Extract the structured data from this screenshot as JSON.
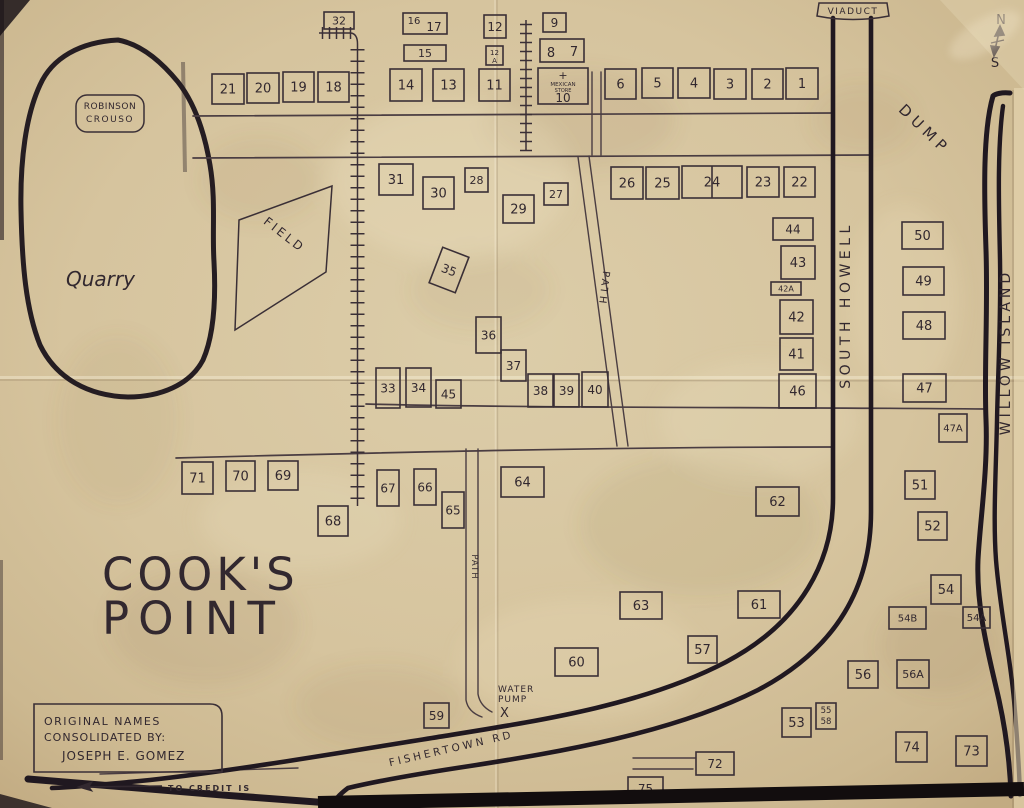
{
  "map": {
    "texts": [
      {
        "id": "viaduct-label",
        "t": "VIADUCT",
        "x": 853,
        "y": 14,
        "fs": 9,
        "ls": 1.5,
        "a": "middle"
      },
      {
        "id": "compass-n",
        "t": "N",
        "x": 1001,
        "y": 24,
        "fs": 13,
        "a": "middle"
      },
      {
        "id": "compass-s",
        "t": "S",
        "x": 995,
        "y": 67,
        "fs": 13,
        "a": "middle"
      },
      {
        "id": "dump-label",
        "t": "DUMP",
        "x": 921,
        "y": 133,
        "fs": 15,
        "ls": 5,
        "rot": 44,
        "a": "middle"
      },
      {
        "id": "south-howell-label",
        "t": "SOUTH HOWELL",
        "x": 850,
        "y": 305,
        "fs": 14,
        "ls": 4.5,
        "rot": -90,
        "a": "middle"
      },
      {
        "id": "willow-island-label",
        "t": "WILLOW ISLAND",
        "x": 1010,
        "y": 352,
        "fs": 14,
        "ls": 4,
        "rot": -90,
        "a": "middle"
      },
      {
        "id": "path-upper-label",
        "t": "PATH",
        "x": 601,
        "y": 288,
        "fs": 10,
        "ls": 2.5,
        "rot": 97,
        "a": "middle"
      },
      {
        "id": "path-lower-label",
        "t": "PATH",
        "x": 472,
        "y": 567,
        "fs": 8.5,
        "ls": 1,
        "rot": 90,
        "a": "middle"
      },
      {
        "id": "robinson-line1",
        "t": "ROBINSON",
        "x": 110,
        "y": 109,
        "fs": 9,
        "ls": 0.5,
        "a": "middle"
      },
      {
        "id": "robinson-line2",
        "t": "CROUSO",
        "x": 110,
        "y": 122,
        "fs": 9,
        "ls": 1.5,
        "a": "middle"
      },
      {
        "id": "quarry-label",
        "t": "Quarry",
        "x": 66,
        "y": 286,
        "fs": 20,
        "it": 1,
        "a": "start"
      },
      {
        "id": "field-label",
        "t": "FIELD",
        "x": 282,
        "y": 238,
        "fs": 12,
        "ls": 3,
        "rot": 38,
        "a": "middle"
      },
      {
        "id": "cooks-line1",
        "t": "COOK'S",
        "x": 102,
        "y": 590,
        "fs": 45,
        "ls": 4,
        "a": "start"
      },
      {
        "id": "cooks-line2",
        "t": "POINT",
        "x": 102,
        "y": 634,
        "fs": 45,
        "ls": 9,
        "a": "start"
      },
      {
        "id": "water-pump-line1",
        "t": "WATER",
        "x": 498,
        "y": 692,
        "fs": 9,
        "ls": 1,
        "a": "start"
      },
      {
        "id": "water-pump-line2",
        "t": "PUMP",
        "x": 498,
        "y": 702,
        "fs": 9,
        "ls": 1,
        "a": "start"
      },
      {
        "id": "water-pump-x",
        "t": "X",
        "x": 500,
        "y": 717,
        "fs": 13,
        "a": "start"
      },
      {
        "id": "fishertown-rd-label",
        "t": "FISHERTOWN RD",
        "x": 452,
        "y": 752,
        "fs": 10.5,
        "ls": 3,
        "rot": -13,
        "a": "middle"
      },
      {
        "id": "credits-line1",
        "t": "ORIGINAL NAMES",
        "x": 44,
        "y": 725,
        "fs": 11,
        "ls": 1.5,
        "a": "start"
      },
      {
        "id": "credits-line2",
        "t": "CONSOLIDATED BY:",
        "x": 44,
        "y": 741,
        "fs": 11,
        "ls": 1,
        "a": "start"
      },
      {
        "id": "credits-line3",
        "t": "JOSEPH E. GOMEZ",
        "x": 62,
        "y": 760,
        "fs": 12,
        "ls": 1,
        "a": "start"
      },
      {
        "id": "to-credit-label",
        "t": "TO CREDIT IS",
        "x": 168,
        "y": 791,
        "fs": 8,
        "ls": 2,
        "w": "bold",
        "a": "start"
      }
    ],
    "lots": [
      {
        "n": "32",
        "x": 324,
        "y": 12,
        "w": 30,
        "h": 17,
        "fs": 11
      },
      {
        "id": "16-17",
        "x": 403,
        "y": 13,
        "w": 44,
        "h": 21,
        "labels": [
          {
            "t": "16",
            "dx": 11,
            "dy": 11,
            "fs": 10
          },
          {
            "t": "17",
            "dx": 31,
            "dy": 18,
            "fs": 12
          }
        ]
      },
      {
        "n": "12",
        "x": 484,
        "y": 15,
        "w": 22,
        "h": 23,
        "fs": 12
      },
      {
        "n": "9",
        "x": 543,
        "y": 13,
        "w": 23,
        "h": 19,
        "fs": 12
      },
      {
        "n": "15",
        "x": 404,
        "y": 45,
        "w": 42,
        "h": 16,
        "fs": 11
      },
      {
        "id": "12A",
        "x": 486,
        "y": 46,
        "w": 17,
        "h": 19,
        "labels": [
          {
            "t": "12",
            "dx": 8.5,
            "dy": 9,
            "fs": 7
          },
          {
            "t": "A",
            "dx": 8.5,
            "dy": 17,
            "fs": 7
          }
        ]
      },
      {
        "id": "8-7",
        "x": 540,
        "y": 39,
        "w": 44,
        "h": 23,
        "labels": [
          {
            "t": "8",
            "dx": 11,
            "dy": 18,
            "fs": 13
          },
          {
            "t": "7",
            "dx": 34,
            "dy": 17,
            "fs": 13
          }
        ]
      },
      {
        "n": "21",
        "x": 212,
        "y": 74,
        "w": 32,
        "h": 30
      },
      {
        "n": "20",
        "x": 247,
        "y": 73,
        "w": 32,
        "h": 30
      },
      {
        "n": "19",
        "x": 283,
        "y": 72,
        "w": 31,
        "h": 30
      },
      {
        "n": "18",
        "x": 318,
        "y": 72,
        "w": 31,
        "h": 30
      },
      {
        "n": "14",
        "x": 390,
        "y": 69,
        "w": 32,
        "h": 32
      },
      {
        "n": "13",
        "x": 433,
        "y": 69,
        "w": 31,
        "h": 32
      },
      {
        "n": "11",
        "x": 479,
        "y": 69,
        "w": 31,
        "h": 32
      },
      {
        "id": "mexican-store-10",
        "x": 538,
        "y": 68,
        "w": 50,
        "h": 36,
        "labels": [
          {
            "t": "+",
            "dx": 25,
            "dy": 11,
            "fs": 11
          },
          {
            "t": "MEXICAN",
            "dx": 25,
            "dy": 18,
            "fs": 5.5
          },
          {
            "t": "STORE",
            "dx": 25,
            "dy": 24,
            "fs": 5
          },
          {
            "t": "10",
            "dx": 25,
            "dy": 34,
            "fs": 12
          }
        ]
      },
      {
        "n": "6",
        "x": 605,
        "y": 69,
        "w": 31,
        "h": 30
      },
      {
        "n": "5",
        "x": 642,
        "y": 68,
        "w": 31,
        "h": 30
      },
      {
        "n": "4",
        "x": 678,
        "y": 68,
        "w": 32,
        "h": 30
      },
      {
        "n": "3",
        "x": 714,
        "y": 69,
        "w": 32,
        "h": 30
      },
      {
        "n": "2",
        "x": 752,
        "y": 69,
        "w": 31,
        "h": 30
      },
      {
        "n": "1",
        "x": 786,
        "y": 68,
        "w": 32,
        "h": 31
      },
      {
        "n": "31",
        "x": 379,
        "y": 164,
        "w": 34,
        "h": 31
      },
      {
        "n": "30",
        "x": 423,
        "y": 177,
        "w": 31,
        "h": 32
      },
      {
        "n": "28",
        "x": 465,
        "y": 168,
        "w": 23,
        "h": 24,
        "fs": 11
      },
      {
        "n": "29",
        "x": 503,
        "y": 195,
        "w": 31,
        "h": 28
      },
      {
        "n": "27",
        "x": 544,
        "y": 183,
        "w": 24,
        "h": 22,
        "fs": 11
      },
      {
        "n": "26",
        "x": 611,
        "y": 167,
        "w": 32,
        "h": 32
      },
      {
        "n": "25",
        "x": 646,
        "y": 167,
        "w": 33,
        "h": 32
      },
      {
        "n": "24",
        "x": 682,
        "y": 166,
        "w": 60,
        "h": 32,
        "divider": true
      },
      {
        "n": "23",
        "x": 747,
        "y": 167,
        "w": 32,
        "h": 30
      },
      {
        "n": "22",
        "x": 784,
        "y": 167,
        "w": 31,
        "h": 30
      },
      {
        "n": "44",
        "x": 773,
        "y": 218,
        "w": 40,
        "h": 22,
        "fs": 12
      },
      {
        "n": "43",
        "x": 781,
        "y": 246,
        "w": 34,
        "h": 33
      },
      {
        "n": "42A",
        "x": 771,
        "y": 282,
        "w": 30,
        "h": 13,
        "fs": 8
      },
      {
        "n": "42",
        "x": 780,
        "y": 300,
        "w": 33,
        "h": 34
      },
      {
        "n": "41",
        "x": 780,
        "y": 338,
        "w": 33,
        "h": 32
      },
      {
        "n": "46",
        "x": 779,
        "y": 374,
        "w": 37,
        "h": 34
      },
      {
        "n": "50",
        "x": 902,
        "y": 222,
        "w": 41,
        "h": 27
      },
      {
        "n": "49",
        "x": 903,
        "y": 267,
        "w": 41,
        "h": 28
      },
      {
        "n": "48",
        "x": 903,
        "y": 312,
        "w": 42,
        "h": 27
      },
      {
        "n": "47",
        "x": 903,
        "y": 374,
        "w": 43,
        "h": 28
      },
      {
        "n": "47A",
        "x": 939,
        "y": 414,
        "w": 28,
        "h": 28,
        "fs": 10
      },
      {
        "n": "35",
        "x": 435,
        "y": 251,
        "w": 28,
        "h": 38,
        "rot": 21,
        "fs": 12
      },
      {
        "n": "36",
        "x": 476,
        "y": 317,
        "w": 25,
        "h": 36,
        "fs": 12
      },
      {
        "n": "37",
        "x": 501,
        "y": 350,
        "w": 25,
        "h": 31,
        "fs": 12
      },
      {
        "n": "33",
        "x": 376,
        "y": 368,
        "w": 24,
        "h": 40,
        "fs": 12
      },
      {
        "n": "34",
        "x": 406,
        "y": 368,
        "w": 25,
        "h": 39,
        "fs": 12
      },
      {
        "n": "45",
        "x": 436,
        "y": 380,
        "w": 25,
        "h": 28,
        "fs": 12
      },
      {
        "n": "38",
        "x": 528,
        "y": 374,
        "w": 25,
        "h": 33,
        "fs": 12
      },
      {
        "n": "39",
        "x": 554,
        "y": 374,
        "w": 25,
        "h": 33,
        "fs": 12
      },
      {
        "n": "40",
        "x": 582,
        "y": 372,
        "w": 26,
        "h": 35,
        "fs": 12
      },
      {
        "n": "71",
        "x": 182,
        "y": 462,
        "w": 31,
        "h": 32
      },
      {
        "n": "70",
        "x": 226,
        "y": 461,
        "w": 29,
        "h": 30
      },
      {
        "n": "69",
        "x": 268,
        "y": 461,
        "w": 30,
        "h": 29
      },
      {
        "n": "68",
        "x": 318,
        "y": 506,
        "w": 30,
        "h": 30
      },
      {
        "n": "67",
        "x": 377,
        "y": 470,
        "w": 22,
        "h": 36,
        "fs": 12
      },
      {
        "n": "66",
        "x": 414,
        "y": 469,
        "w": 22,
        "h": 36,
        "fs": 12
      },
      {
        "n": "65",
        "x": 442,
        "y": 492,
        "w": 22,
        "h": 36,
        "fs": 12
      },
      {
        "n": "64",
        "x": 501,
        "y": 467,
        "w": 43,
        "h": 30
      },
      {
        "n": "62",
        "x": 756,
        "y": 487,
        "w": 43,
        "h": 29
      },
      {
        "n": "51",
        "x": 905,
        "y": 471,
        "w": 30,
        "h": 28
      },
      {
        "n": "52",
        "x": 918,
        "y": 512,
        "w": 29,
        "h": 28
      },
      {
        "n": "54",
        "x": 931,
        "y": 575,
        "w": 30,
        "h": 29
      },
      {
        "n": "54B",
        "x": 889,
        "y": 607,
        "w": 37,
        "h": 22,
        "fs": 10
      },
      {
        "n": "54A",
        "x": 963,
        "y": 607,
        "w": 27,
        "h": 21,
        "fs": 10
      },
      {
        "n": "56",
        "x": 848,
        "y": 661,
        "w": 30,
        "h": 27
      },
      {
        "n": "56A",
        "x": 897,
        "y": 660,
        "w": 32,
        "h": 28,
        "fs": 11
      },
      {
        "id": "55-58",
        "x": 816,
        "y": 703,
        "w": 20,
        "h": 26,
        "labels": [
          {
            "t": "55",
            "dx": 10,
            "dy": 10,
            "fs": 8.5
          },
          {
            "t": "58",
            "dx": 10,
            "dy": 21,
            "fs": 8.5
          }
        ]
      },
      {
        "n": "53",
        "x": 782,
        "y": 708,
        "w": 29,
        "h": 29
      },
      {
        "n": "74",
        "x": 896,
        "y": 732,
        "w": 31,
        "h": 30
      },
      {
        "n": "73",
        "x": 956,
        "y": 736,
        "w": 31,
        "h": 30
      },
      {
        "n": "63",
        "x": 620,
        "y": 592,
        "w": 42,
        "h": 27
      },
      {
        "n": "61",
        "x": 738,
        "y": 591,
        "w": 42,
        "h": 27
      },
      {
        "n": "57",
        "x": 688,
        "y": 636,
        "w": 29,
        "h": 27
      },
      {
        "n": "60",
        "x": 555,
        "y": 648,
        "w": 43,
        "h": 28
      },
      {
        "n": "59",
        "x": 424,
        "y": 703,
        "w": 25,
        "h": 25,
        "fs": 12
      },
      {
        "n": "72",
        "x": 696,
        "y": 752,
        "w": 38,
        "h": 23,
        "fs": 12
      },
      {
        "n": "75",
        "x": 628,
        "y": 777,
        "w": 35,
        "h": 23,
        "fs": 12
      }
    ],
    "rails": [
      {
        "dir": "v",
        "x": 357.5,
        "y1": 44,
        "y2": 506,
        "step": 11.5,
        "tick": 14
      },
      {
        "dir": "v",
        "x": 526,
        "y1": 20,
        "y2": 151,
        "step": 9,
        "tick": 12
      },
      {
        "dir": "h",
        "y": 33,
        "x1": 319,
        "x2": 351,
        "step": 7,
        "tick": 12
      }
    ],
    "ink_color": "#32282f",
    "road_color": "#201820",
    "paper_color": "#d8c6a1"
  }
}
